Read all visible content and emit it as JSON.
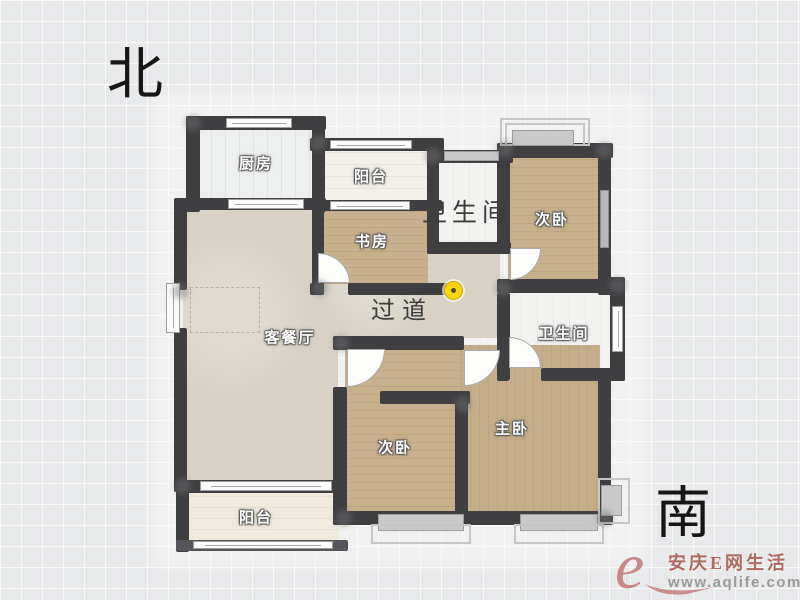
{
  "compass": {
    "north": "北",
    "south": "南"
  },
  "rooms": {
    "kitchen": {
      "label": "厨房"
    },
    "balcony_top": {
      "label": "阳台"
    },
    "study": {
      "label": "书房"
    },
    "bathroom_top": {
      "label": "卫生间"
    },
    "bedroom_top": {
      "label": "次卧"
    },
    "living_dining": {
      "label": "客餐厅"
    },
    "hallway": {
      "label": "过道"
    },
    "bathroom_master": {
      "label": "卫生间"
    },
    "bedroom_second": {
      "label": "次卧"
    },
    "master_bedroom": {
      "label": "主卧"
    },
    "balcony_bottom": {
      "label": "阳台"
    }
  },
  "watermark": {
    "logo_letter": "e",
    "brand": "安庆E网生活",
    "url": "www.aqlife.com"
  },
  "colors": {
    "wall": "#3f3f42",
    "wood_floor": "#c9b08c",
    "tile_floor": "#eef0ef",
    "living_floor": "#d8d2c6",
    "marker_yellow": "#ffd60a",
    "watermark_red": "#ae695d",
    "watermark_gray": "#9a9a9a"
  }
}
